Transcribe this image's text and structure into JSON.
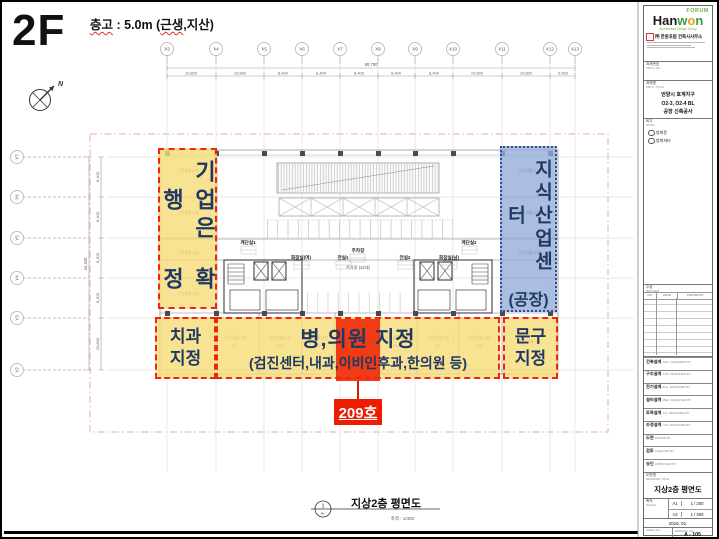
{
  "header": {
    "floor_label": "2F",
    "note_p1": "층고",
    "note_p2": " : 5.0m (",
    "note_p3": "근생",
    "note_p4": ",지산)"
  },
  "compass": {
    "north": "N"
  },
  "grid": {
    "x_labels": [
      "X3",
      "X4",
      "X5",
      "X6",
      "X7",
      "X8",
      "X9",
      "X10",
      "X11",
      "X12",
      "X13"
    ],
    "x_total": "90,700",
    "x_dims": [
      "10,800",
      "10,800",
      "8,400",
      "8,400",
      "8,400",
      "8,400",
      "8,400",
      "10,800",
      "10,800",
      "5,500"
    ],
    "y_labels": [
      "Y7",
      "Y6",
      "Y5",
      "Y4",
      "Y3",
      "Y2"
    ],
    "y_total": "44,400",
    "y_dims": [
      "8,400",
      "8,400",
      "8,400",
      "8,400",
      "10,800"
    ]
  },
  "plan": {
    "stair1": "계단실1",
    "stair2": "계단실2",
    "toilet_w": "화장실(여)",
    "toilet_m": "화장실(남)",
    "vest1": "전실1",
    "vest2": "전실2",
    "parking": "주차장",
    "parking_note": "주차장 (22대)",
    "unit_label": "근린생활시설",
    "room_numbers": [
      "212",
      "211",
      "210",
      "208",
      "207",
      "206"
    ]
  },
  "overlays": {
    "bank": {
      "text1": "기업은행",
      "text2": "확정"
    },
    "industry": {
      "text1": "지식산업센터",
      "text2": "(공장)"
    },
    "dental": {
      "line1": "치과",
      "line2": "지정"
    },
    "hospital": {
      "line1": "병,의원 지정",
      "line2": "(검진센터,내과,이비인후과,한의원 등)"
    },
    "stationery": {
      "line1": "문구",
      "line2": "지정"
    },
    "room209": {
      "label": "209호"
    }
  },
  "footer": {
    "ref_top": "1",
    "ref_bottom": "A-",
    "title": "지상2층 평면도",
    "scale": "축척 : 1/400"
  },
  "titleblock": {
    "forum": "FORUM",
    "logo_p1": "Han",
    "logo_p2": "w",
    "logo_p3": "o",
    "logo_p4": "n",
    "tagline": "Architecture Design Group",
    "company": "㈜ 한원포럼 건축사사무소",
    "proj_no_label": "과제번호",
    "proj_no_en": "PROJ. NO",
    "proj_title_label": "과제명",
    "proj_title_en": "PROJ. TITLE",
    "proj_title_line1": "안양시 호계지구",
    "proj_title_line2": "O2-3, O2-4 BL",
    "proj_title_line3": "공장 신축공사",
    "note_label": "비고",
    "note_en": "NOTE",
    "note_item1": "방화문",
    "note_item2": "방화셔터",
    "revised_label": "수정",
    "revised_en": "REVISED",
    "rev_col1": "NO.",
    "rev_col2": "DATE",
    "rev_col3": "CONTENTS",
    "fields": [
      {
        "kr": "건축설계",
        "en": "ARC. DESIGNED BY"
      },
      {
        "kr": "구조설계",
        "en": "STR. DESIGNED BY"
      },
      {
        "kr": "전기설계",
        "en": "ELE. DESIGNED BY"
      },
      {
        "kr": "설비설계",
        "en": "MEC. DESIGNED BY"
      },
      {
        "kr": "토목설계",
        "en": "CIV. DESIGNED BY"
      },
      {
        "kr": "조경설계",
        "en": "LAN. DESIGNED BY"
      },
      {
        "kr": "도면",
        "en": "DRAWN BY"
      },
      {
        "kr": "검토",
        "en": "CHECKED BY"
      },
      {
        "kr": "승인",
        "en": "APPROVED BY"
      }
    ],
    "title_label": "도면명",
    "title_en": "DRAWING TITLE",
    "drawing_title": "지상2층 평면도",
    "scale_label": "축척",
    "scale_en": "SCALE",
    "scale_a1_label": "A1",
    "scale_a1": "1 / 200",
    "scale_a3_label": "A3",
    "scale_a3": "1 / 400",
    "date": "2016. 01.",
    "sheet_label": "SHEET NO",
    "dwg_label": "DRAWING NO",
    "dwg_no": "A - 105"
  },
  "colors": {
    "accent_red": "#ee2512",
    "overlay_yellow": "#f7dd7a",
    "overlay_blue": "#94acd8",
    "navy": "#1f3864",
    "highlight": "#f03b14"
  }
}
